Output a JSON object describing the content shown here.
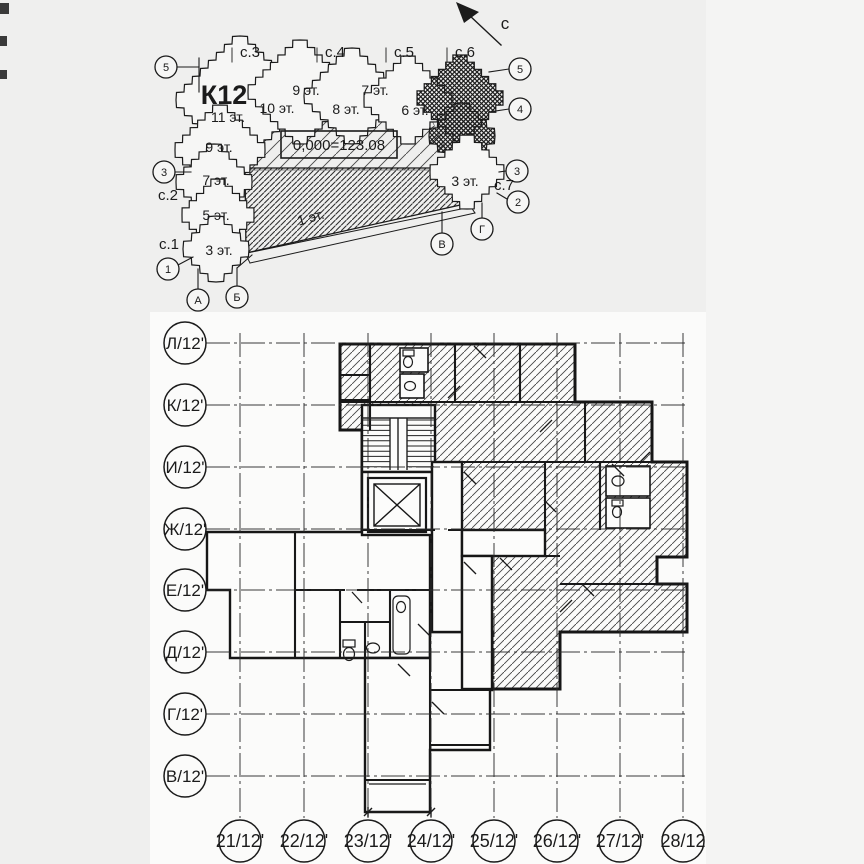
{
  "page": {
    "bg": "#efefee",
    "paper": "#fbfbfa",
    "right_strip": "#f4f4f3",
    "ink": "#1b1b1b"
  },
  "north": {
    "label": "с"
  },
  "site_plan": {
    "building_label": "К12",
    "elevation_text": "0,000=123.08",
    "top_sections": [
      "с.3",
      "с.4",
      "с.5",
      "с.6"
    ],
    "side_sections": {
      "s2": "с.2",
      "s1": "с.1",
      "s7": "с.7"
    },
    "floors": {
      "f11": "11 эт.",
      "f9_left": "9 эт.",
      "f9_top": "9 эт.",
      "f10": "10 эт.",
      "f8": "8 эт.",
      "f7_top": "7 эт.",
      "f6": "6 эт.",
      "f7_left": "7 эт.",
      "f5": "5 эт.",
      "f3_left": "3 эт.",
      "f3_right": "3 эт.",
      "f1": "1 эт."
    },
    "axes_left": [
      "5",
      "3",
      "1"
    ],
    "axes_right": [
      "5",
      "4",
      "3",
      "2"
    ],
    "axes_bottom": [
      "А",
      "Б",
      "В",
      "Г"
    ]
  },
  "floor_plan": {
    "row_axes": [
      "Л/12'",
      "К/12'",
      "И/12'",
      "Ж/12'",
      "Е/12'",
      "Д/12'",
      "Г/12'",
      "В/12'"
    ],
    "col_axes": [
      "21/12'",
      "22/12'",
      "23/12'",
      "24/12'",
      "25/12'",
      "26/12'",
      "27/12'",
      "28/12"
    ]
  }
}
